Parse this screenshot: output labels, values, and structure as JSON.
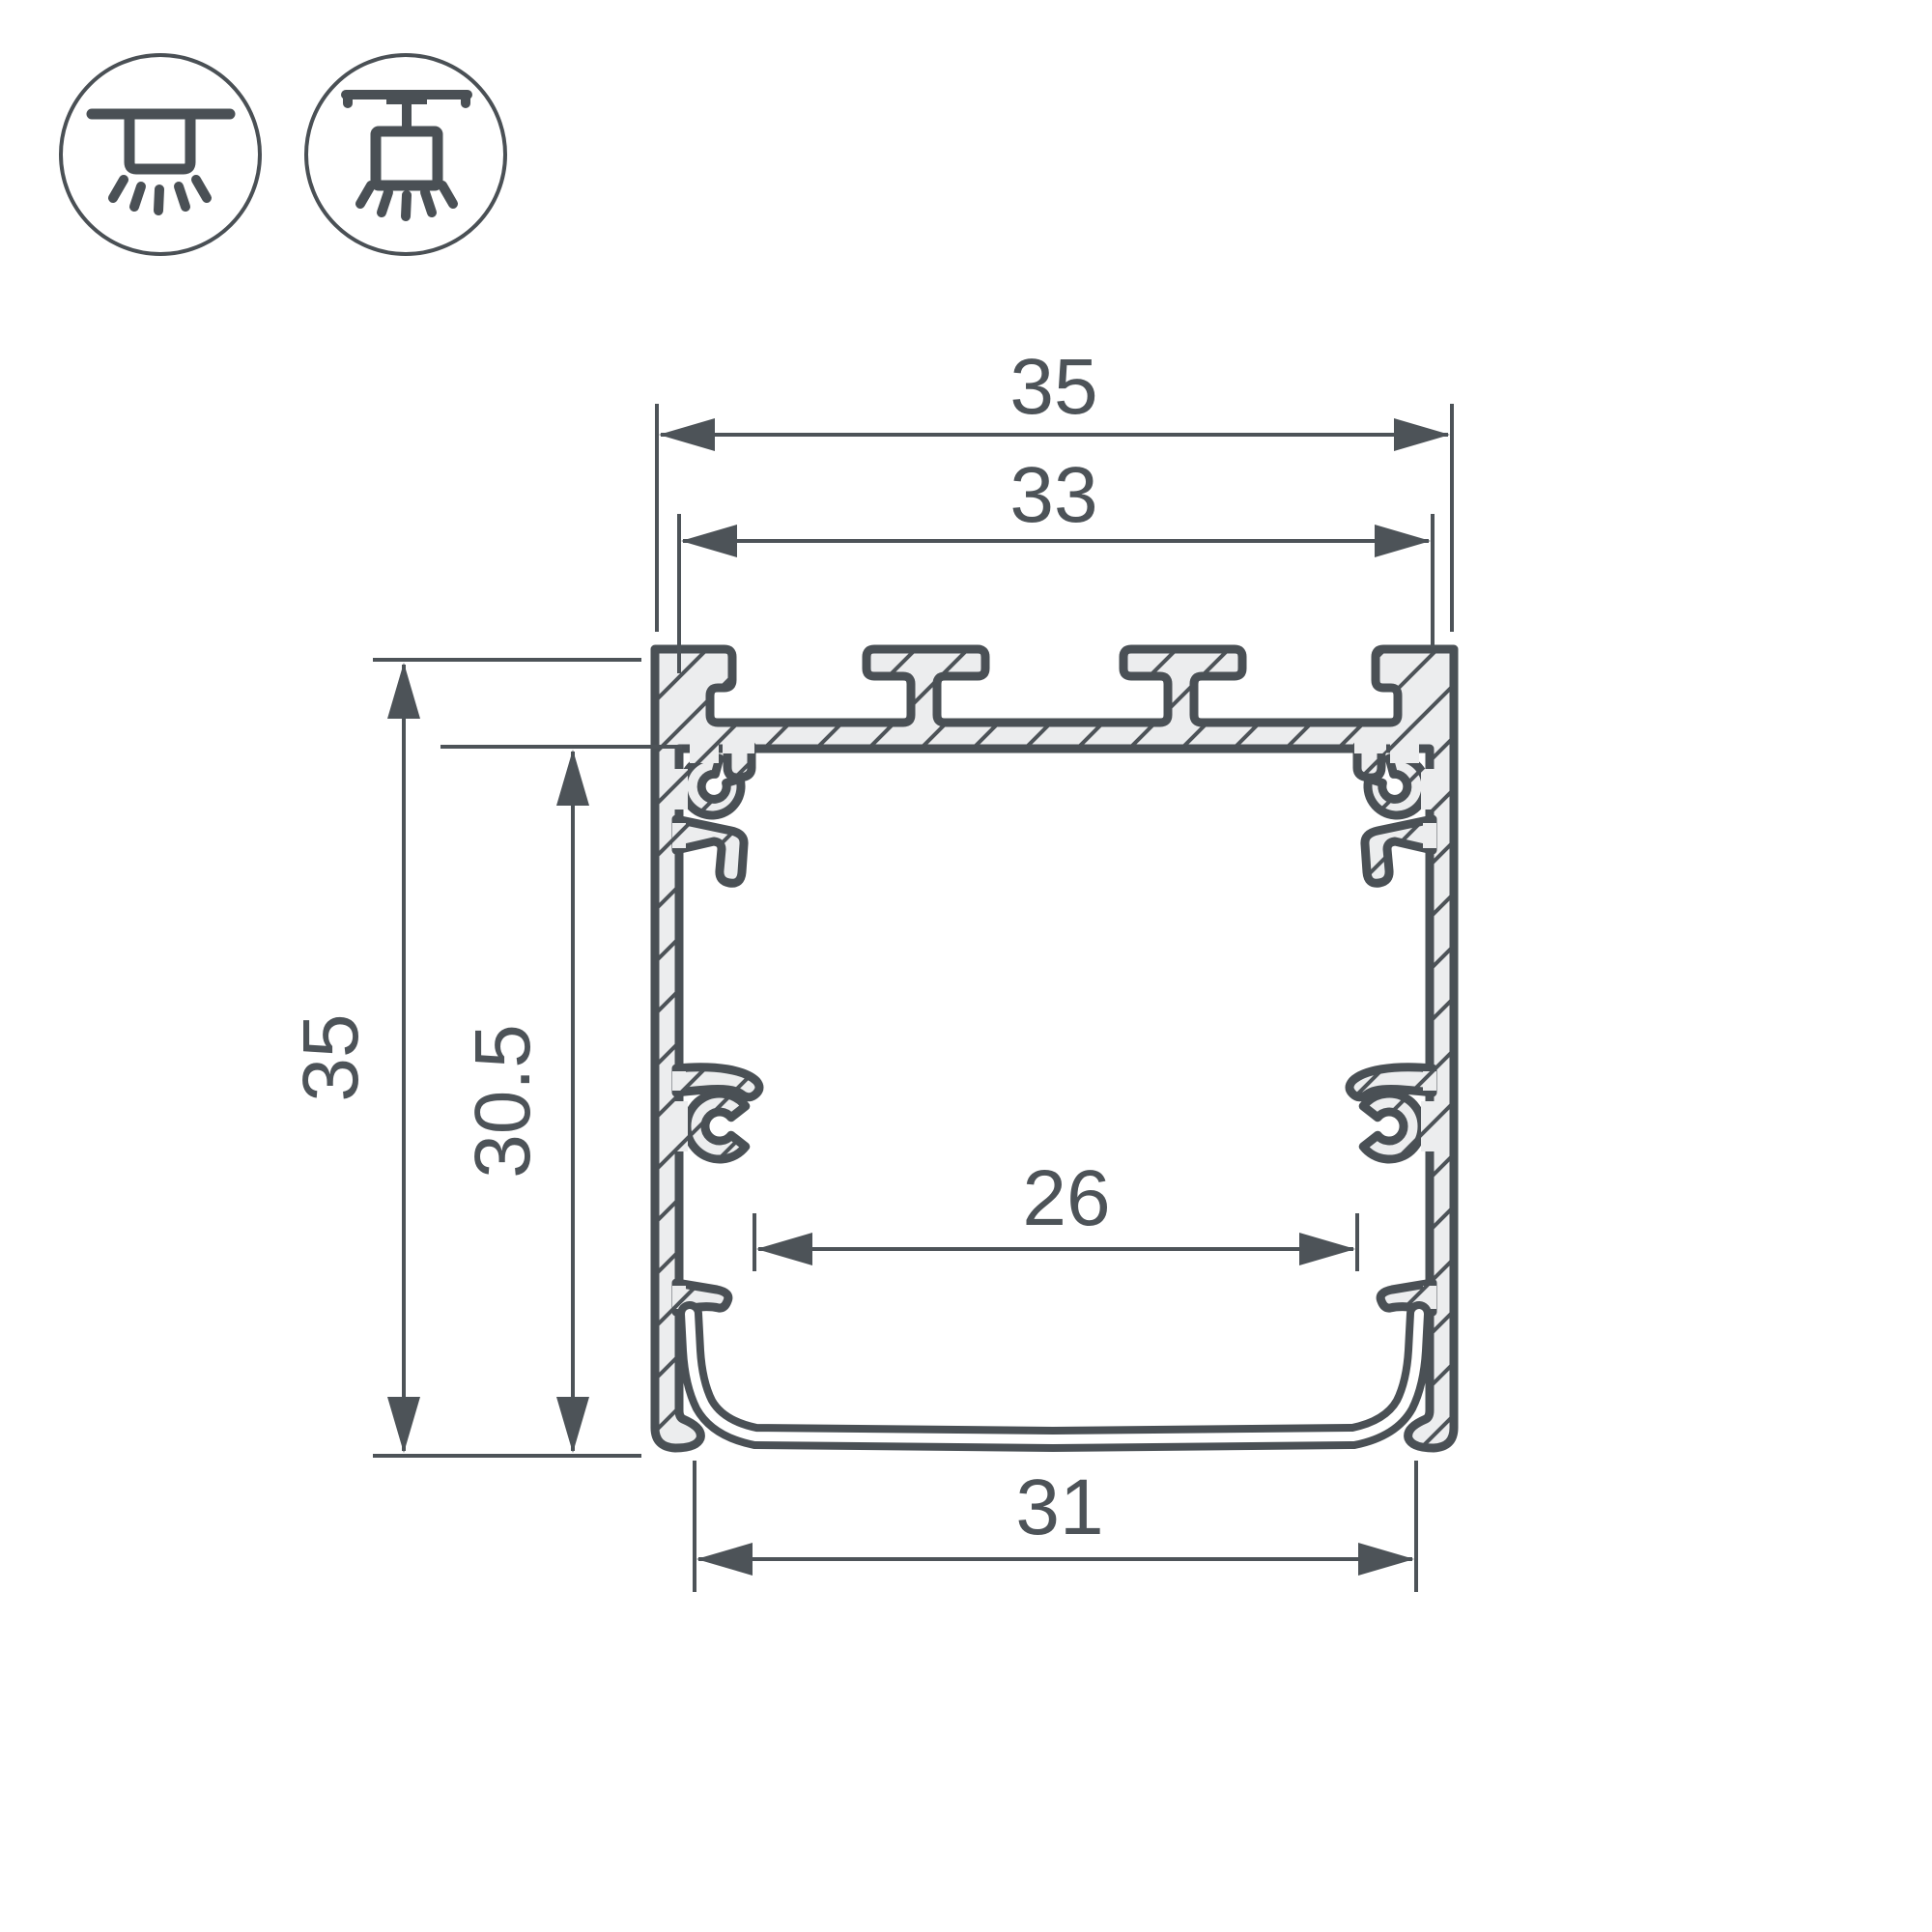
{
  "drawing": {
    "title": "LED profile cross-section dimensional drawing",
    "dimensions": {
      "top_outer_width": "35",
      "top_inner_width": "33",
      "left_outer_height": "35",
      "left_inner_height": "30.5",
      "middle_inner_width": "26",
      "bottom_cover_width": "31"
    },
    "icons": [
      {
        "name": "surface-mount-icon",
        "meaning": "recessed / surface ceiling mounting"
      },
      {
        "name": "suspended-mount-icon",
        "meaning": "suspended / pendant mounting"
      }
    ],
    "colors": {
      "line": "#4a5055",
      "dim_line": "#4d5358",
      "metal_fill": "#ecedee",
      "background": "#ffffff"
    }
  }
}
